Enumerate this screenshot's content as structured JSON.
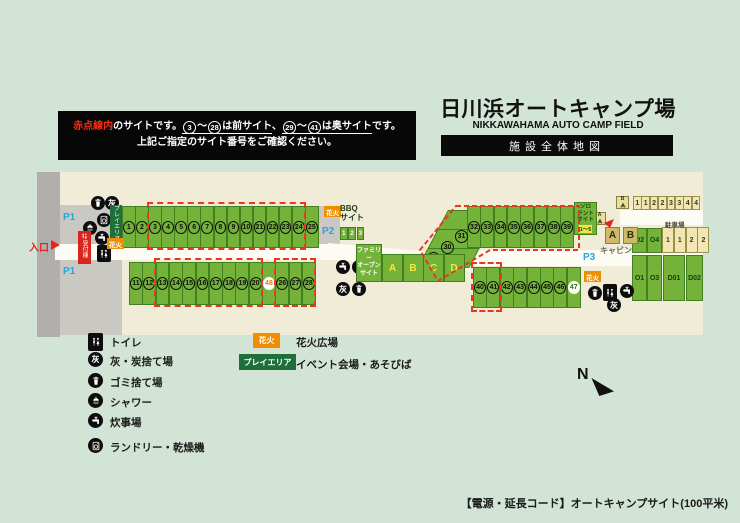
{
  "banner": {
    "prefix_red": "赤点線内",
    "seg1": "のサイトです。",
    "n1": "3",
    "tilde1": "〜",
    "n2": "28",
    "seg2": "は前サイト",
    "comma": "、",
    "n3": "29",
    "tilde2": "〜",
    "n4": "41",
    "seg3": "は奥サイト",
    "seg4": "です。",
    "line2": "上記ご指定のサイト番号をご確認ください。"
  },
  "title": {
    "ja": "日川浜オートキャンプ場",
    "en": "NIKKAWAHAMA AUTO CAMP FIELD",
    "bar": "施設全体地図"
  },
  "map": {
    "entrance": "入口",
    "p1": "P1",
    "p2": "P2",
    "p3": "P3",
    "hanabi_tag": "花火",
    "play_tag": "プレイエリア",
    "reception": "受付棟",
    "ash": "灰",
    "front_row": [
      "1",
      "2",
      "3",
      "4",
      "5",
      "6",
      "7",
      "8",
      "9",
      "10",
      "21",
      "22",
      "23",
      "24",
      "25"
    ],
    "second_row": [
      "11",
      "12",
      "13",
      "14",
      "15",
      "16",
      "17",
      "18",
      "19",
      "20",
      "48",
      "26",
      "27",
      "28"
    ],
    "diagonal_sites": [
      "29",
      "30",
      "31"
    ],
    "back_row": [
      "32",
      "33",
      "34",
      "35",
      "36",
      "37",
      "38",
      "39"
    ],
    "far_row": [
      "40",
      "41",
      "42",
      "43",
      "44",
      "45",
      "46",
      "47"
    ],
    "bbq_label": "BBQ\nサイト",
    "bbq_sites": [
      "1",
      "2",
      "3"
    ],
    "family_label": "ファミリー\nオープン\nサイト",
    "family_sites": [
      "A",
      "B",
      "C",
      "D"
    ],
    "solo_label": "ソロ\nテント\nサイト",
    "solo_range": "1〜5",
    "cabin_label": "キャビン",
    "cabin_units": [
      "A",
      "B"
    ],
    "o_sites": [
      "O2",
      "O4",
      "O1",
      "O3"
    ],
    "d_sites": [
      "D01",
      "D02"
    ],
    "top_stalls": [
      "1",
      "1",
      "2",
      "2",
      "3",
      "3",
      "4",
      "4"
    ],
    "parking_label": "駐車場",
    "parking_stalls": [
      "1",
      "1",
      "2",
      "2"
    ],
    "tent_tags": [
      "A",
      "B"
    ],
    "compass": "N"
  },
  "legend": {
    "items": [
      {
        "icon": "wc-icon",
        "label": "トイレ"
      },
      {
        "icon": "ash-icon",
        "label": "灰・炭捨て場"
      },
      {
        "icon": "trash-icon",
        "label": "ゴミ捨て場"
      },
      {
        "icon": "shower-icon",
        "label": "シャワー"
      },
      {
        "icon": "faucet-icon",
        "label": "炊事場"
      },
      {
        "icon": "laundry-icon",
        "label": "ランドリー・乾燥機"
      }
    ],
    "hanabi_tag": "花火",
    "hanabi_label": "花火広場",
    "play_tag": "プレイエリア",
    "play_label": "イベント会場・あそびば"
  },
  "footer": "【電源・延長コード】オートキャンプサイト(100平米)",
  "colors": {
    "site_green": "#74b23a",
    "red_dash": "#e8391f",
    "orange": "#ef8e00",
    "dark_green": "#1e6f3a",
    "blue": "#2aa5dc",
    "reception_red": "#d8261e"
  }
}
